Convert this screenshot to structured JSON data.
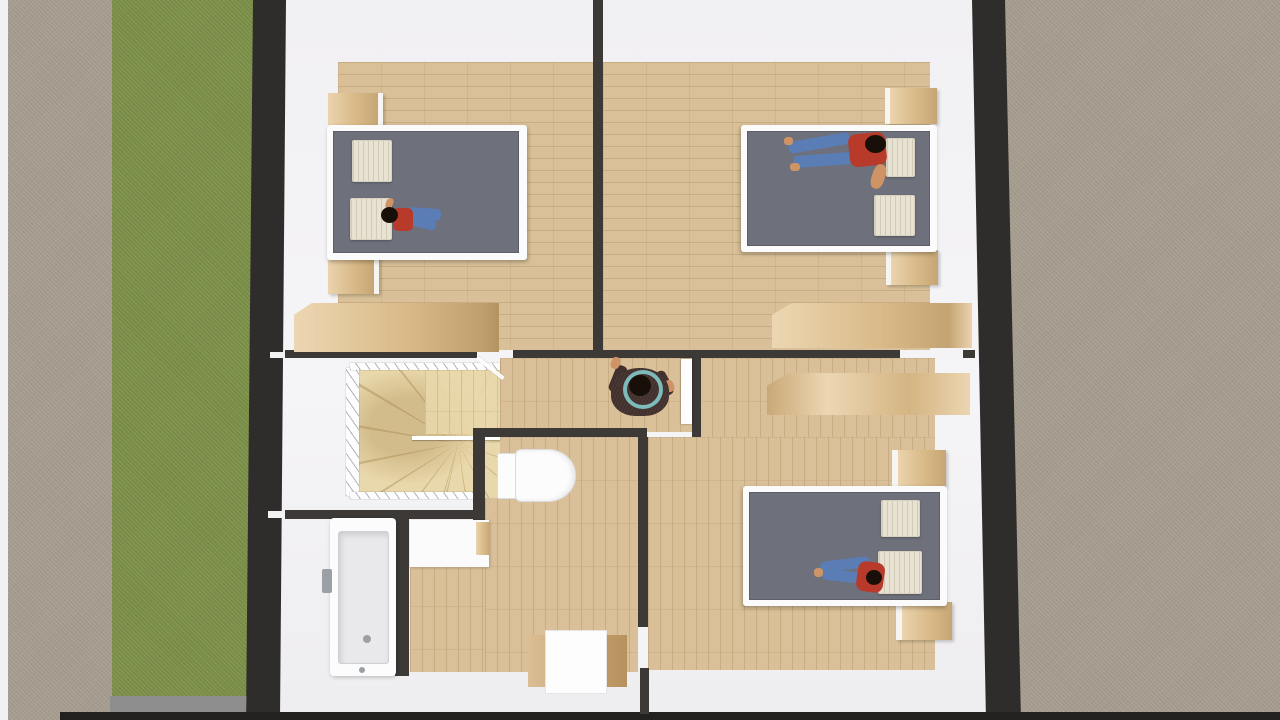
{
  "scene": {
    "view": "top-down-3d-floor-plan-render",
    "level": "upper-floor",
    "rooms": [
      {
        "id": "bedroom-top-left",
        "contents": [
          "double-bed",
          "two-pillows",
          "two-nightstands",
          "wardrobe",
          "person-lying"
        ]
      },
      {
        "id": "bedroom-top-right",
        "contents": [
          "double-bed",
          "two-pillows",
          "two-nightstands",
          "wardrobe",
          "person-lying"
        ]
      },
      {
        "id": "bedroom-bottom-right",
        "contents": [
          "double-bed",
          "two-pillows",
          "two-nightstands",
          "wardrobe",
          "person-lying"
        ]
      },
      {
        "id": "hallway",
        "contents": [
          "person-standing-arms-raised",
          "open-door"
        ]
      },
      {
        "id": "stairwell",
        "contents": [
          "winder-staircase",
          "railing"
        ]
      },
      {
        "id": "wc-room",
        "contents": [
          "toilet",
          "vanity",
          "desk"
        ]
      },
      {
        "id": "bathroom",
        "contents": [
          "bathtub",
          "faucet"
        ]
      }
    ],
    "exterior": [
      "gravel-path-left",
      "lawn-strip",
      "concrete-pad",
      "gravel-area-right"
    ],
    "people_count": 4
  },
  "colors": {
    "wallExterior": "#2f2d2b",
    "wallInterior": "#3c3937",
    "wallBottom": "#232120",
    "interior": "#f3f2f4",
    "pathGray": "#a89f91",
    "lawn": "#7c9147",
    "concrete": "#8e8e8f",
    "woodFloor": "#d9c098",
    "stairWood": "#e9d8ab",
    "furnWood": "#e4c592",
    "furnWoodDark": "#d0a973",
    "bedFrame": "#fcfbfb",
    "duvet": "#6e707b",
    "pillow": "#e7e2d1",
    "porcelain": "#fcfcfd",
    "tubInner": "#e9e9ec",
    "metal": "#9aa0a4",
    "skin": "#cf9465",
    "hair": "#181008",
    "shirt": "#b73a2b",
    "jeans": "#5a7db5",
    "jacket": "#42302d",
    "teal": "#86d4d3"
  }
}
